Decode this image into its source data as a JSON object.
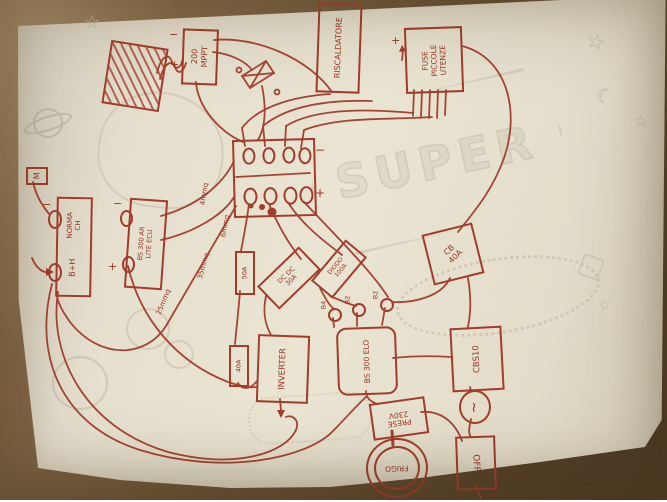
{
  "meta": {
    "description": "Photo of a hand-drawn camper electrical wiring diagram, red ink on cream paper with faint printed doodles, lying on a brown table"
  },
  "colors": {
    "ink": "#a63a2b",
    "ink_text": "#9b3223",
    "paper": "#ece6d6",
    "table": "#6b5339",
    "doodle": "#c3bdae"
  },
  "background_print": {
    "badge_text": "SUPER"
  },
  "labels": {
    "mppt_line1": "200",
    "mppt_line2": "MPPT",
    "heater": "RISCALDATORE",
    "fuse_line1": "FUSE",
    "fuse_line2": "PICCOLE",
    "fuse_line3": "UTENZE",
    "ground": "M",
    "battery1_line1": "NORMA",
    "battery1_line2": "CH",
    "battery2": "B+H",
    "ecu_line1": "BS 300 AR",
    "ecu_line2": "LITE ECU",
    "wire4": "4mmq",
    "wire6": "6mmq",
    "wire35": "35mmq",
    "wire25": "25mmq",
    "fuse50": "50A",
    "fuse40": "40A",
    "dcdc_line1": "DC DC",
    "dcdc_line2": "30A",
    "diode_line1": "DIODO",
    "diode_line2": "100A",
    "b4": "B4",
    "b2_mid": "B2",
    "b2_right": "B2",
    "inverter": "INVERTER",
    "bs300": "BS 300 ELO",
    "breaker_line1": "CB",
    "breaker_line2": "40A",
    "cbs": "CBS10",
    "ac": "~",
    "sockets_line1": "PRESE",
    "sockets_line2": "230V",
    "fridge": "FRIGO",
    "off": "OFF",
    "plus": "+",
    "minus": "−"
  }
}
